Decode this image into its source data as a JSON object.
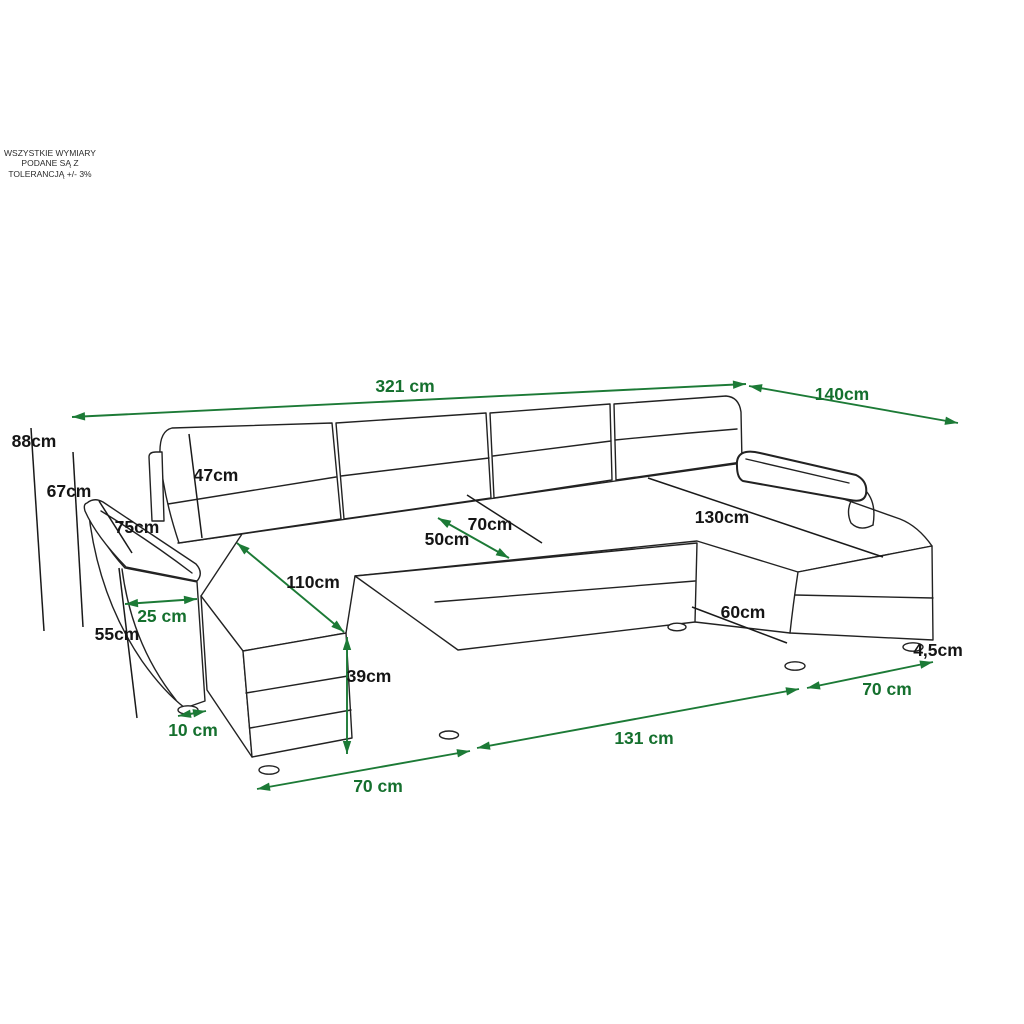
{
  "note": {
    "text": "WSZYSTKIE WYMIARY\nPODANE SĄ Z\nTOLERANCJĄ +/- 3%"
  },
  "palette": {
    "dimension_green_line": "#1c7a36",
    "dimension_green_text": "#15702e",
    "dimension_black_line": "#1a1a1a",
    "dimension_black_text": "#151515",
    "sofa_outline": "#222222",
    "background": "#ffffff"
  },
  "dimensions": [
    {
      "id": "321cm",
      "label": "321 cm",
      "line": "green",
      "text": "green"
    },
    {
      "id": "140cm",
      "label": "140cm",
      "line": "green",
      "text": "green"
    },
    {
      "id": "50cm",
      "label": "50cm",
      "line": "green",
      "text": "black"
    },
    {
      "id": "110cm",
      "label": "110cm",
      "line": "green",
      "text": "black"
    },
    {
      "id": "39cm",
      "label": "39cm",
      "line": "green",
      "text": "black"
    },
    {
      "id": "25cm",
      "label": "25 cm",
      "line": "green",
      "text": "green"
    },
    {
      "id": "10cm",
      "label": "10 cm",
      "line": "green",
      "text": "green"
    },
    {
      "id": "70cm-bl",
      "label": "70 cm",
      "line": "green",
      "text": "green"
    },
    {
      "id": "131cm",
      "label": "131 cm",
      "line": "green",
      "text": "green"
    },
    {
      "id": "70cm-br",
      "label": "70 cm",
      "line": "green",
      "text": "green"
    },
    {
      "id": "88cm",
      "label": "88cm",
      "line": "black",
      "text": "black"
    },
    {
      "id": "67cm",
      "label": "67cm",
      "line": "black",
      "text": "black"
    },
    {
      "id": "47cm",
      "label": "47cm",
      "line": "black",
      "text": "black"
    },
    {
      "id": "75cm",
      "label": "75cm",
      "line": "black",
      "text": "black"
    },
    {
      "id": "55cm",
      "label": "55cm",
      "line": "black",
      "text": "black"
    },
    {
      "id": "70cm-mid",
      "label": "70cm",
      "line": "black",
      "text": "black"
    },
    {
      "id": "130cm",
      "label": "130cm",
      "line": "black",
      "text": "black"
    },
    {
      "id": "60cm",
      "label": "60cm",
      "line": "black",
      "text": "black"
    },
    {
      "id": "4-5cm",
      "label": "4,5cm",
      "line": "none",
      "text": "black"
    }
  ]
}
